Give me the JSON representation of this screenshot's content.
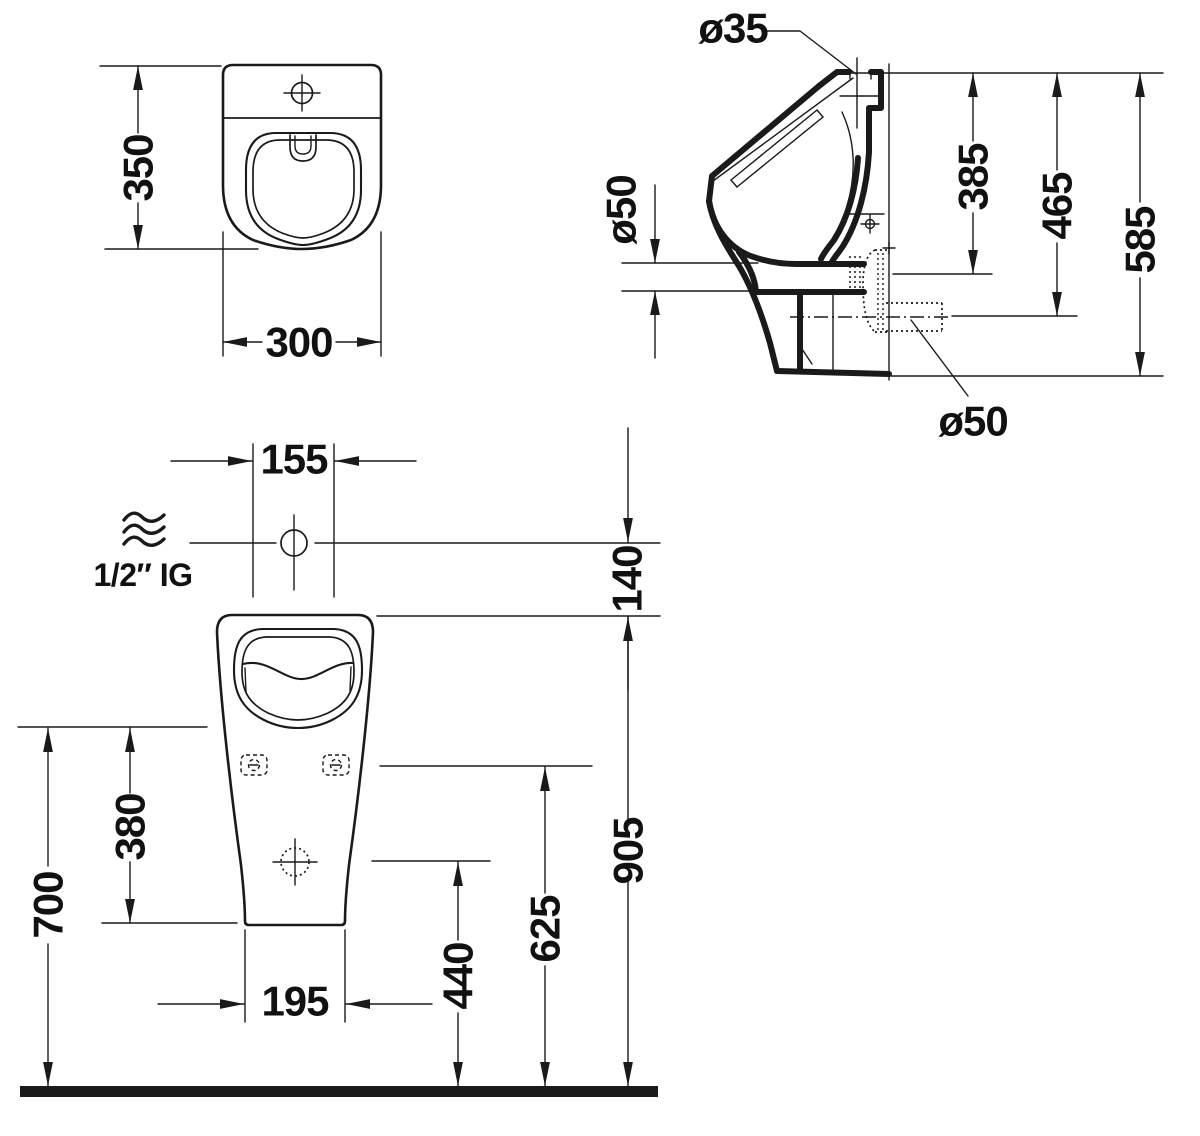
{
  "drawing": {
    "top_view": {
      "dim_height": "350",
      "dim_width": "300"
    },
    "side_view": {
      "label_inlet_diameter": "ø35",
      "label_trap_diameter": "ø50",
      "label_outlet_diameter": "ø50",
      "dim_inlet_depth": "385",
      "dim_outlet_depth": "465",
      "dim_total_depth": "585"
    },
    "front_view": {
      "dim_inlet_offset": "155",
      "dim_rim_to_inlet": "140",
      "label_water_supply": "1/2″ IG",
      "dim_body_height": "380",
      "dim_lower_height": "700",
      "dim_base_width": "195",
      "dim_outlet_height": "440",
      "dim_fixing_height": "625",
      "dim_rim_height": "905"
    }
  }
}
